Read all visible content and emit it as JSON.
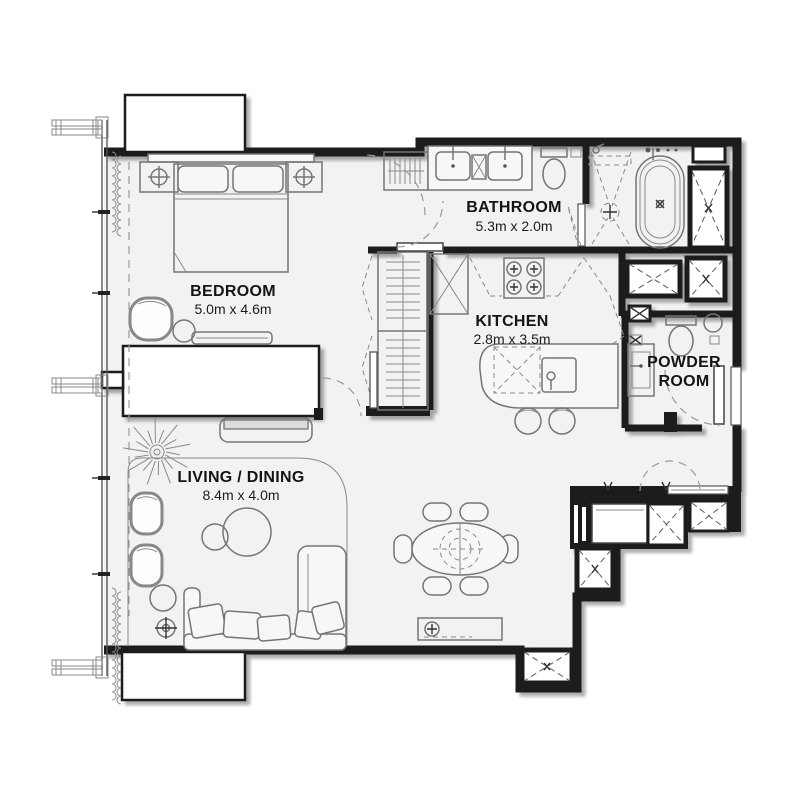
{
  "page": {
    "background": "#ffffff"
  },
  "colors": {
    "wall": "#1b1b1b",
    "floor": "#f2f2f0",
    "furniture_line": "#757575",
    "dashed_line": "#9a9a9a",
    "label_text": "#141414"
  },
  "rooms": {
    "bedroom": {
      "name": "BEDROOM",
      "dims": "5.0m x 4.6m"
    },
    "bathroom": {
      "name": "BATHROOM",
      "dims": "5.3m x 2.0m"
    },
    "kitchen": {
      "name": "KITCHEN",
      "dims": "2.8m x 3.5m"
    },
    "powder_room": {
      "name_line1": "POWDER",
      "name_line2": "ROOM"
    },
    "living_dining": {
      "name": "LIVING / DINING",
      "dims": "8.4m x 4.0m"
    }
  }
}
